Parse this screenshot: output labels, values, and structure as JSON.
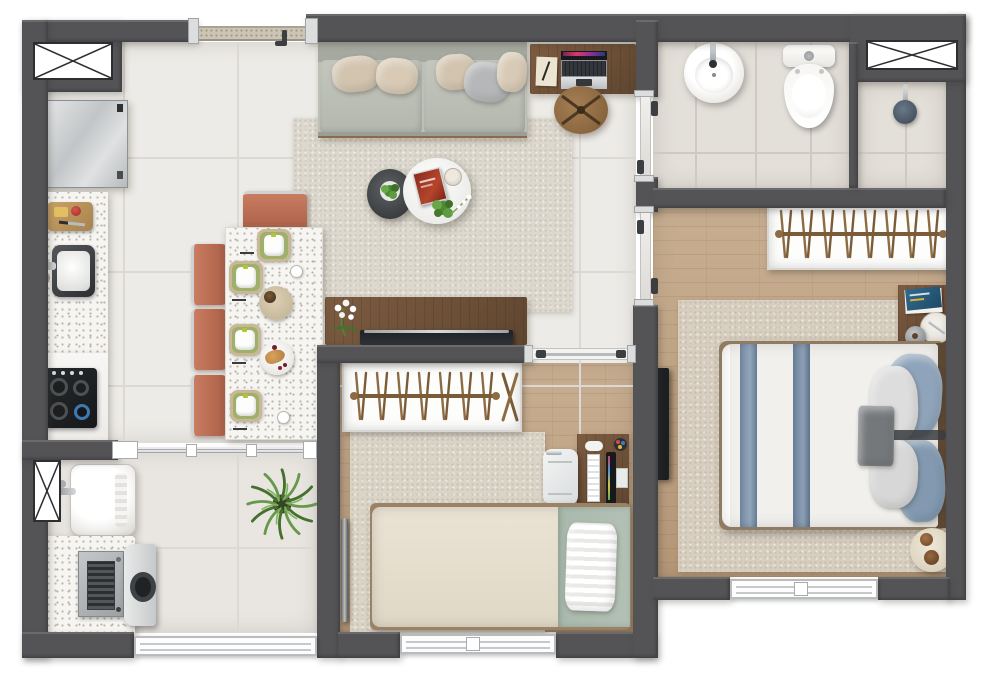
{
  "document": {
    "kind": "apartment floor plan",
    "view": "top-down 3D render",
    "has_text": false
  },
  "colors": {
    "wall": "#545457",
    "wall-hi": "#6a6a6d",
    "tile": "#edebe7",
    "tile-line": "#dcd8d3",
    "bath-tile": "#e3dfd9",
    "bath-line": "#cfc9c1",
    "laundry-tile": "#e9e6e2",
    "wood": "#c8ae91",
    "wood-dark": "#b69878",
    "rug-living": "#dcd8cd",
    "rug-master": "#d7cec0",
    "rug-bed2": "#dad4c7",
    "terrazzo": "#f6f5f2",
    "speckle": "#bdb8ae",
    "furn-wood": "#7d5c41",
    "furn-wood-dark": "#5f4630",
    "terracotta": "#bd7056",
    "chrome": "#c6c9ca",
    "steel-dark": "#3c3f42",
    "sofa": "#bcc0b6",
    "sofa-dark": "#a6a99f",
    "pillow-beige": "#d2c4ae",
    "pillow-gray": "#b5b7b8",
    "white": "#fbfbfa",
    "dark": "#26292c",
    "green-dark": "#46702e",
    "green-light": "#68994b",
    "sage": "#b3c1b5",
    "duvet": "#f1f0ed",
    "blue": "#8599b1",
    "blue-pillow": "#8fa4ba",
    "gray-throw": "#75787b",
    "headboard": "#5d4834",
    "glass": "#e7e5e1",
    "threshold": "#ccc5b3",
    "cream": "#ece4d3"
  },
  "rooms": {
    "kitchen": {
      "name": "Kitchen",
      "furniture": [
        "service shaft",
        "refrigerator",
        "terrazzo counter with cutting board and sink",
        "cooktop counter",
        "green jars"
      ]
    },
    "dining": {
      "name": "Dining area",
      "furniture": [
        "terrazzo dining table",
        "4 terracotta chairs",
        "4 green place settings",
        "serving tray with cups",
        "croissant plate"
      ]
    },
    "living": {
      "name": "Living room",
      "furniture": [
        "sofa with pillows",
        "round coffee table",
        "knit pouf with plant",
        "red book",
        "candle",
        "TV sideboard with white orchid",
        "TV",
        "wall desk",
        "laptop",
        "notepad",
        "round wooden chair",
        "rug"
      ]
    },
    "entry": {
      "name": "Entry",
      "furniture": [
        "entrance threshold",
        "door handle"
      ]
    },
    "bathroom": {
      "name": "Bathroom",
      "furniture": [
        "round washbasin",
        "toilet",
        "shower with glass partition",
        "shower head",
        "service shaft",
        "sliding glass door"
      ]
    },
    "master_bedroom": {
      "name": "Master bedroom",
      "furniture": [
        "double bed with blue runners",
        "open wardrobe with hangers",
        "nightstand with books and tray",
        "wall TV",
        "round side table with cups",
        "rug",
        "window",
        "sliding glass door"
      ]
    },
    "bedroom2": {
      "name": "Second bedroom",
      "furniture": [
        "single bed with sage blanket",
        "open wardrobe with hangers",
        "desk with monitor and keyboard",
        "white desk chair",
        "leaning mirror",
        "rug",
        "window",
        "sliding door track"
      ]
    },
    "laundry": {
      "name": "Laundry / service area",
      "furniture": [
        "laundry tub",
        "washing machine",
        "terrazzo counter",
        "service shaft",
        "palm plant",
        "sliding glass partition",
        "window"
      ]
    }
  }
}
